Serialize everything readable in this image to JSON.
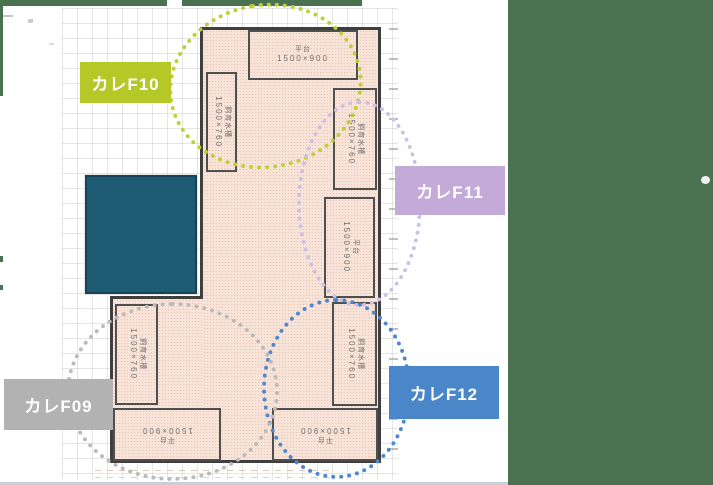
{
  "colors": {
    "outer_background": "#4a7251",
    "canvas_background": "#ffffff",
    "floor_fill": "#f8e3d9",
    "wall": "#3f3f3f",
    "teal_block": "#1e5b74"
  },
  "annotations": {
    "f10": {
      "label": "カレF10",
      "box_color": "#b4c827",
      "circle_color": "#bdd133"
    },
    "f11": {
      "label": "カレF11",
      "box_color": "#c3aad8",
      "circle_color": "#cfbfe4"
    },
    "f12": {
      "label": "カレF12",
      "box_color": "#4b86c9",
      "circle_color": "#4f87cd"
    },
    "f09": {
      "label": "カレF09",
      "box_color": "#b2b2b2",
      "circle_color": "#bababa"
    }
  },
  "plan": {
    "rooms": [
      {
        "name": "平台",
        "size": "1500×900"
      },
      {
        "name": "飼育水槽",
        "size": "1500×760"
      },
      {
        "name": "飼育水槽",
        "size": "1500×760"
      },
      {
        "name": "平台",
        "size": "1500×900"
      },
      {
        "name": "飼育水槽",
        "size": "1500×760"
      },
      {
        "name": "平台",
        "size": "1500×900"
      },
      {
        "name": "飼育水槽",
        "size": "1500×760"
      },
      {
        "name": "平台",
        "size": "1500×900"
      }
    ]
  }
}
